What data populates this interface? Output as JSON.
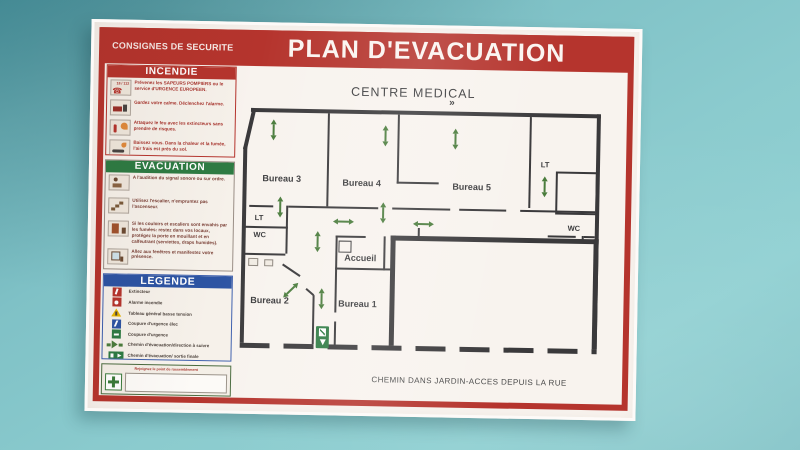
{
  "poster": {
    "kicker": "CONSIGNES DE SECURITE",
    "title": "PLAN D'EVACUATION",
    "incendie": {
      "title": "INCENDIE",
      "items": [
        {
          "icon": "emergency-phone-icon",
          "badge": "18 / 112",
          "text": "Prévenez les SAPEURS POMPIERS ou le service d'URGENCE EUROPEEN."
        },
        {
          "icon": "fire-truck-icon",
          "text": "Gardez votre calme. Déclenchez l'alarme."
        },
        {
          "icon": "fire-extinguisher-use-icon",
          "text": "Attaquez le feu avec les extincteurs sans prendre de risques."
        },
        {
          "icon": "crouch-under-smoke-icon",
          "text": "Baissez vous. Dans la chaleur et la fumée, l'air frais est près du sol."
        }
      ]
    },
    "evacuation": {
      "title": "EVACUATION",
      "items": [
        {
          "icon": "alarm-listen-icon",
          "text": "A l'audition du signal sonore ou sur ordre."
        },
        {
          "icon": "stairs-icon",
          "text": "Utilisez l'escalier, n'empruntez pas l'ascenseur."
        },
        {
          "icon": "blocked-corridor-icon",
          "text": "Si les couloirs et escaliers sont envahis par les fumées: restez dans vos locaux, protégez la porte en mouillant et en calfeutrant (serviettes, draps humides)."
        },
        {
          "icon": "window-signal-icon",
          "text": "Allez aux fenêtres et manifestez votre présence."
        }
      ]
    },
    "legende": {
      "title": "LEGENDE",
      "items": [
        {
          "icon": "extinguisher-icon",
          "label": "Extincteur"
        },
        {
          "icon": "fire-alarm-icon",
          "label": "Alarme incendie"
        },
        {
          "icon": "low-voltage-board-icon",
          "label": "Tableau général basse tension"
        },
        {
          "icon": "power-cut-elec-icon",
          "label": "Coupure d'urgence élec"
        },
        {
          "icon": "power-cut-icon",
          "label": "Coupure d'urgence"
        },
        {
          "icon": "evac-direction-icon",
          "label": "Chemin d'évacuation/direction à suivre"
        },
        {
          "icon": "final-exit-icon",
          "label": "Chemin d'évacuation/ sortie finale"
        }
      ]
    },
    "rassemblement": {
      "label": "Rejoignez le point de rassemblement"
    },
    "plan": {
      "title": "CENTRE MEDICAL",
      "mark": "»",
      "rooms": {
        "bureau3": "Bureau 3",
        "bureau4": "Bureau 4",
        "bureau5": "Bureau 5",
        "lt_right": "LT",
        "wc_right": "WC",
        "lt_left": "LT",
        "wc_left": "WC",
        "accueil": "Accueil",
        "bureau2": "Bureau 2",
        "bureau1": "Bureau 1"
      },
      "footer": "CHEMIN DANS JARDIN-ACCES DEPUIS LA RUE"
    },
    "colors": {
      "banner_red": "#b5342d",
      "evac_green": "#2e7b43",
      "legend_blue": "#2d54a3",
      "arrow_green": "#4a7c3c",
      "wall_line": "#3a393b",
      "wall_paint": "#7fc1c6"
    }
  }
}
